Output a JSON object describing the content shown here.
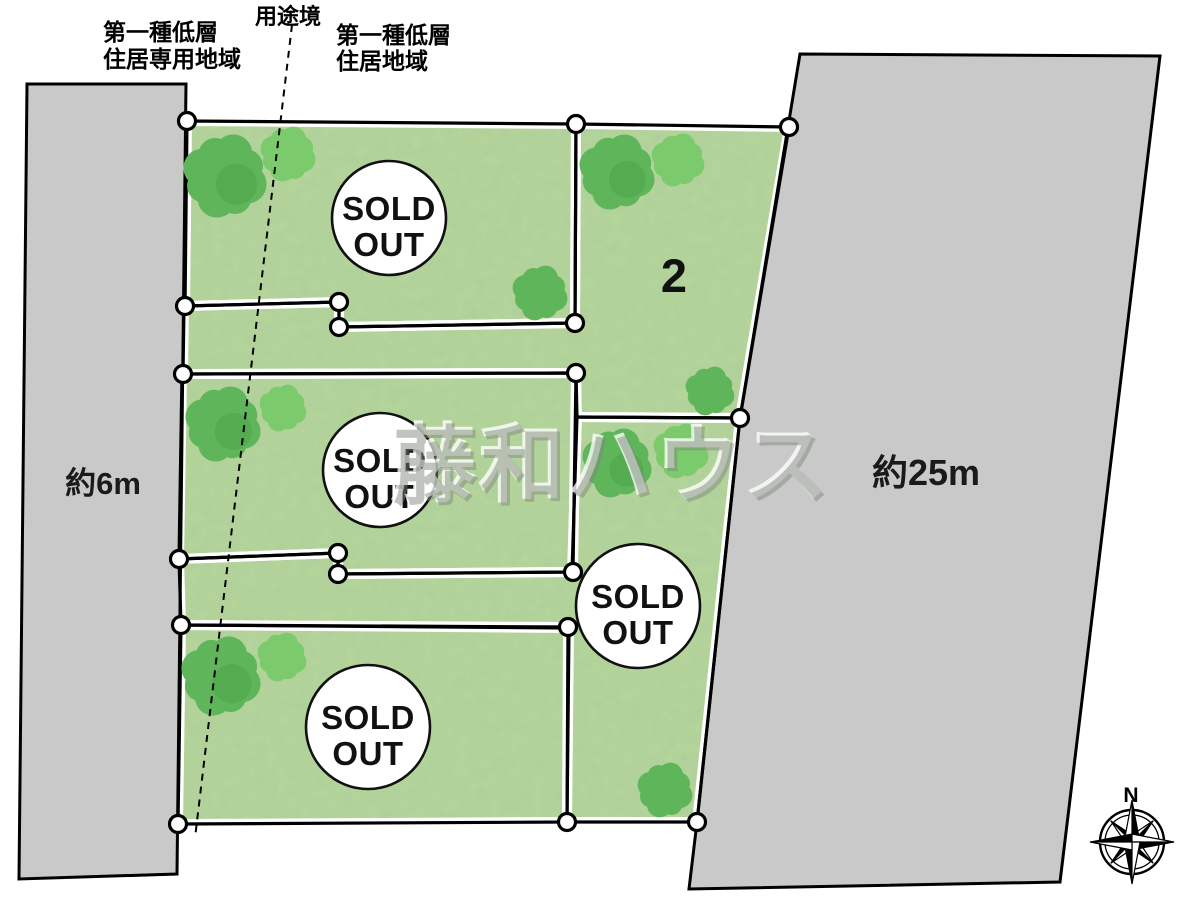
{
  "labels": {
    "zone_left_line1": "第一種低層",
    "zone_left_line2": "住居専用地域",
    "zone_boundary": "用途境",
    "zone_right_line1": "第一種低層",
    "zone_right_line2": "住居地域",
    "road_west_width": "約6m",
    "road_east_width": "約25m",
    "watermark": "藤和ハウス",
    "compass_north": "N"
  },
  "lots": [
    {
      "id": "1",
      "status": "SOLD OUT",
      "marker": {
        "cx": 389,
        "cy": 218,
        "r": 57
      }
    },
    {
      "id": "2",
      "number": "2"
    },
    {
      "id": "3",
      "status": "SOLD OUT",
      "marker": {
        "cx": 380,
        "cy": 470,
        "r": 57
      }
    },
    {
      "id": "4",
      "status": "SOLD OUT",
      "marker": {
        "cx": 638,
        "cy": 606,
        "r": 62
      }
    },
    {
      "id": "5",
      "status": "SOLD OUT",
      "marker": {
        "cx": 368,
        "cy": 727,
        "r": 62
      }
    }
  ],
  "map": {
    "colors": {
      "grass": "#b6d69a",
      "road": "#c9c9c9",
      "line": "#000000",
      "casing": "#ffffff",
      "vertex_fill": "#ffffff",
      "tree_dark": "#5fb65a",
      "tree_light": "#7bca6c",
      "tree_patch": "#4aa248"
    },
    "parcels": [
      {
        "name": "lot-1",
        "points": [
          [
            187,
            121
          ],
          [
            576,
            124
          ],
          [
            575,
            323
          ],
          [
            339,
            327
          ],
          [
            339,
            302
          ],
          [
            185,
            306
          ]
        ]
      },
      {
        "name": "lot-2",
        "points": [
          [
            576,
            124
          ],
          [
            789,
            127
          ],
          [
            740,
            418
          ],
          [
            577,
            417
          ],
          [
            576,
            373
          ],
          [
            183,
            374
          ],
          [
            184,
            306
          ],
          [
            339,
            302
          ],
          [
            339,
            327
          ],
          [
            575,
            323
          ]
        ]
      },
      {
        "name": "lot-3",
        "points": [
          [
            182,
            374
          ],
          [
            576,
            373
          ],
          [
            573,
            572
          ],
          [
            338,
            574
          ],
          [
            338,
            553
          ],
          [
            179,
            559
          ]
        ]
      },
      {
        "name": "lot-4",
        "points": [
          [
            577,
            417
          ],
          [
            740,
            418
          ],
          [
            697,
            822
          ],
          [
            567,
            822
          ],
          [
            569,
            628
          ],
          [
            181,
            625
          ],
          [
            179,
            559
          ],
          [
            338,
            553
          ],
          [
            338,
            574
          ],
          [
            572,
            572
          ]
        ]
      },
      {
        "name": "lot-5",
        "points": [
          [
            181,
            625
          ],
          [
            568,
            627
          ],
          [
            567,
            822
          ],
          [
            178,
            824
          ]
        ]
      }
    ],
    "roads": [
      {
        "name": "road-west",
        "points": [
          [
            27,
            84
          ],
          [
            186,
            84
          ],
          [
            177,
            874
          ],
          [
            19,
            879
          ]
        ]
      },
      {
        "name": "road-east",
        "points": [
          [
            800,
            54
          ],
          [
            1160,
            56
          ],
          [
            1060,
            882
          ],
          [
            689,
            889
          ],
          [
            697,
            822
          ],
          [
            740,
            418
          ]
        ]
      }
    ],
    "vertices": [
      [
        187,
        121
      ],
      [
        576,
        124
      ],
      [
        789,
        127
      ],
      [
        185,
        306
      ],
      [
        339,
        302
      ],
      [
        339,
        327
      ],
      [
        575,
        323
      ],
      [
        183,
        374
      ],
      [
        576,
        373
      ],
      [
        740,
        418
      ],
      [
        179,
        559
      ],
      [
        338,
        553
      ],
      [
        338,
        574
      ],
      [
        573,
        572
      ],
      [
        181,
        625
      ],
      [
        568,
        627
      ],
      [
        178,
        824
      ],
      [
        567,
        822
      ],
      [
        697,
        822
      ]
    ],
    "trees": [
      {
        "x": 225,
        "y": 176,
        "r": 41,
        "shade": "dark",
        "patch": true
      },
      {
        "x": 288,
        "y": 154,
        "r": 27,
        "shade": "light",
        "patch": false
      },
      {
        "x": 617,
        "y": 172,
        "r": 37,
        "shade": "dark",
        "patch": true
      },
      {
        "x": 678,
        "y": 160,
        "r": 26,
        "shade": "light",
        "patch": false
      },
      {
        "x": 540,
        "y": 293,
        "r": 27,
        "shade": "dark",
        "patch": false
      },
      {
        "x": 223,
        "y": 424,
        "r": 37,
        "shade": "dark",
        "patch": true
      },
      {
        "x": 283,
        "y": 408,
        "r": 23,
        "shade": "light",
        "patch": false
      },
      {
        "x": 617,
        "y": 463,
        "r": 34,
        "shade": "dark",
        "patch": true
      },
      {
        "x": 681,
        "y": 451,
        "r": 27,
        "shade": "light",
        "patch": false
      },
      {
        "x": 710,
        "y": 391,
        "r": 24,
        "shade": "dark",
        "patch": false
      },
      {
        "x": 221,
        "y": 676,
        "r": 39,
        "shade": "dark",
        "patch": true
      },
      {
        "x": 282,
        "y": 657,
        "r": 24,
        "shade": "light",
        "patch": false
      },
      {
        "x": 665,
        "y": 790,
        "r": 27,
        "shade": "dark",
        "patch": false
      }
    ],
    "dashed_line": {
      "x1": 292,
      "y1": 25,
      "x2": 195,
      "y2": 838
    },
    "compass": {
      "cx": 1132,
      "cy": 842,
      "ring_r": 32,
      "inner_r": 27,
      "cardinal_tip": 42,
      "diagonal_tip": 30,
      "cardinal_base": 8,
      "diagonal_base": 6
    }
  }
}
